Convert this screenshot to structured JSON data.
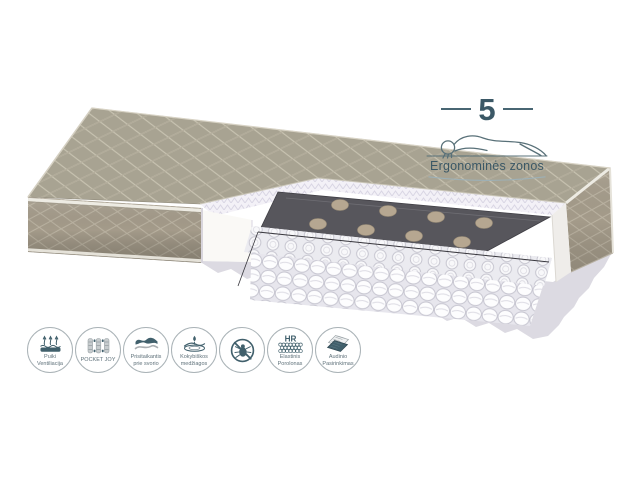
{
  "badge": {
    "number": "5",
    "label": "Ergonominės zonos"
  },
  "features": [
    {
      "id": "ventilation",
      "label": "Puiki Ventiliacija"
    },
    {
      "id": "pocket-joy",
      "label": "POCKET JOY"
    },
    {
      "id": "weight-adapt",
      "label": "Prisitaikantis prie svorio"
    },
    {
      "id": "quality-materials",
      "label": "Kokybiškos medžiagos"
    },
    {
      "id": "anti-dustmite",
      "label": ""
    },
    {
      "id": "hr-foam",
      "label": "Elastinis Porolonas",
      "glyph_text": "HR"
    },
    {
      "id": "fabric-choice",
      "label": "Audinio Pasirinkimas"
    }
  ],
  "palette": {
    "fabric_top": "#a8a392",
    "fabric_side": "#a49b8a",
    "foam_white": "#f3f1f7",
    "felt_dark": "#57565c",
    "spring_white": "#fdfdfe",
    "pocket_tan": "#b6a791",
    "base_gray": "#dcdae2",
    "accent_slate": "#3b5866",
    "icon_border": "#aab3b7"
  }
}
